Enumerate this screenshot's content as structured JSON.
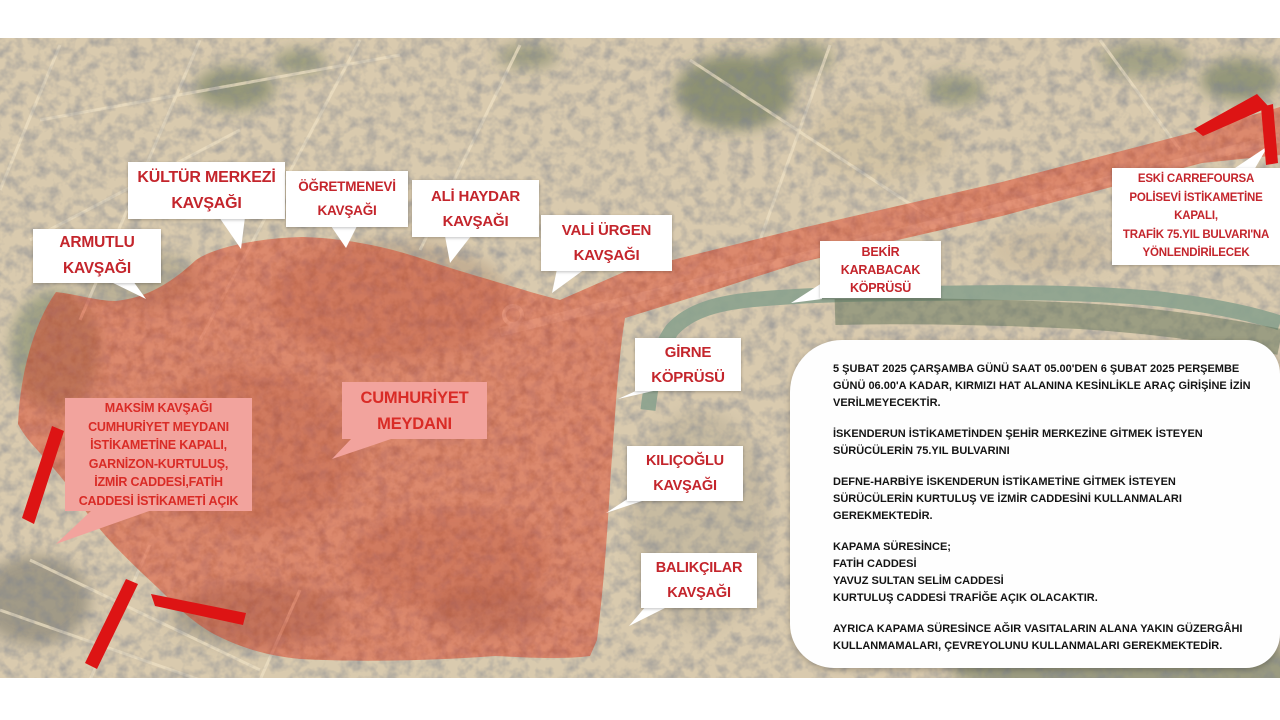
{
  "colors": {
    "closure_zone_red": "#e03a20",
    "accent_arrow_red": "#dd1414",
    "callout_text_red": "#c4252c",
    "pink_note_bg": "#f2a39d",
    "map_base_tan": "#d9caae",
    "river_green": "#8ba28e",
    "announcement_text": "#141414"
  },
  "callouts": [
    {
      "id": "armutlu",
      "label": "ARMUTLU\nKAVŞAĞI"
    },
    {
      "id": "kultur",
      "label": "KÜLTÜR MERKEZİ\nKAVŞAĞI"
    },
    {
      "id": "ogretmenevi",
      "label": "ÖĞRETMENEVİ\nKAVŞAĞI"
    },
    {
      "id": "alihaydar",
      "label": "ALİ HAYDAR\nKAVŞAĞI"
    },
    {
      "id": "valiurgen",
      "label": "VALİ ÜRGEN\nKAVŞAĞI"
    },
    {
      "id": "bekir",
      "label": "BEKİR\nKARABACAK\nKÖPRÜSÜ"
    },
    {
      "id": "girne",
      "label": "GİRNE\nKÖPRÜSÜ"
    },
    {
      "id": "kilicoglu",
      "label": "KILIÇOĞLU\nKAVŞAĞI"
    },
    {
      "id": "balikcilar",
      "label": "BALIKÇILAR\nKAVŞAĞI"
    },
    {
      "id": "eski",
      "label": "ESKİ CARREFOURSA\nPOLİSEVİ İSTİKAMETİNE\nKAPALI,\nTRAFİK 75.YIL BULVARI'NA\nYÖNLENDİRİLECEK"
    }
  ],
  "pink_notes": [
    {
      "id": "maksim",
      "label": "MAKSİM KAVŞAĞI\nCUMHURİYET MEYDANI\nİSTİKAMETİNE KAPALI,\nGARNİZON-KURTULUŞ,\nİZMİR CADDESİ,FATİH\nCADDESİ İSTİKAMETİ AÇIK"
    },
    {
      "id": "cumhuriyet",
      "label": "CUMHURİYET\nMEYDANI"
    }
  ],
  "announcement": {
    "paragraphs": [
      "5 ŞUBAT 2025 ÇARŞAMBA GÜNÜ SAAT 05.00'DEN 6 ŞUBAT 2025 PERŞEMBE GÜNÜ 06.00'A KADAR, KIRMIZI HAT ALANINA KESİNLİKLE ARAÇ GİRİŞİNE İZİN VERİLMEYECEKTİR.",
      "İSKENDERUN İSTİKAMETİNDEN ŞEHİR MERKEZİNE GİTMEK İSTEYEN SÜRÜCÜLERİN 75.YIL BULVARINI",
      "DEFNE-HARBİYE İSKENDERUN İSTİKAMETİNE GİTMEK İSTEYEN SÜRÜCÜLERİN KURTULUŞ VE İZMİR CADDESİNİ KULLANMALARI GEREKMEKTEDİR.",
      "KAPAMA SÜRESİNCE;\nFATİH CADDESİ\nYAVUZ SULTAN SELİM CADDESİ\nKURTULUŞ CADDESİ TRAFİĞE AÇIK OLACAKTIR.",
      "AYRICA KAPAMA SÜRESİNCE AĞIR VASITALARIN ALANA YAKIN GÜZERGÂHI KULLANMAMALARI, ÇEVREYOLUNU KULLANMALARI GEREKMEKTEDİR."
    ]
  }
}
